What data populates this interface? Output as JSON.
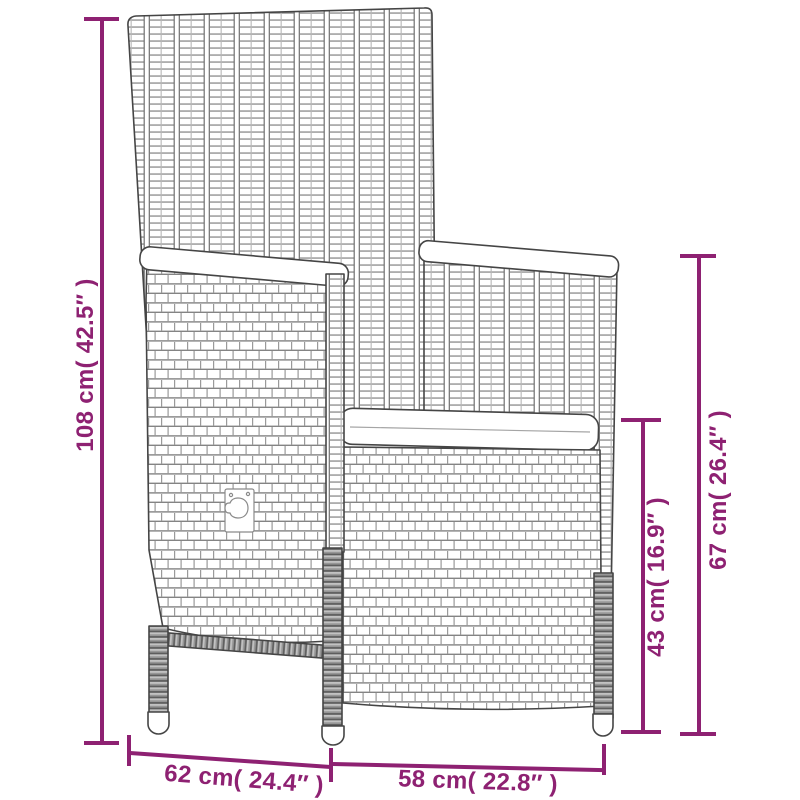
{
  "colors": {
    "dimension_accent": "#8E2172",
    "outline": "#454545",
    "background": "#ffffff"
  },
  "dimensions": {
    "overall_height": "108 cm( 42.5″ )",
    "arm_height": "67 cm( 26.4″ )",
    "seat_height": "43 cm( 16.9″ )",
    "depth": "62 cm( 24.4″ )",
    "width": "58 cm( 22.8″ )"
  }
}
